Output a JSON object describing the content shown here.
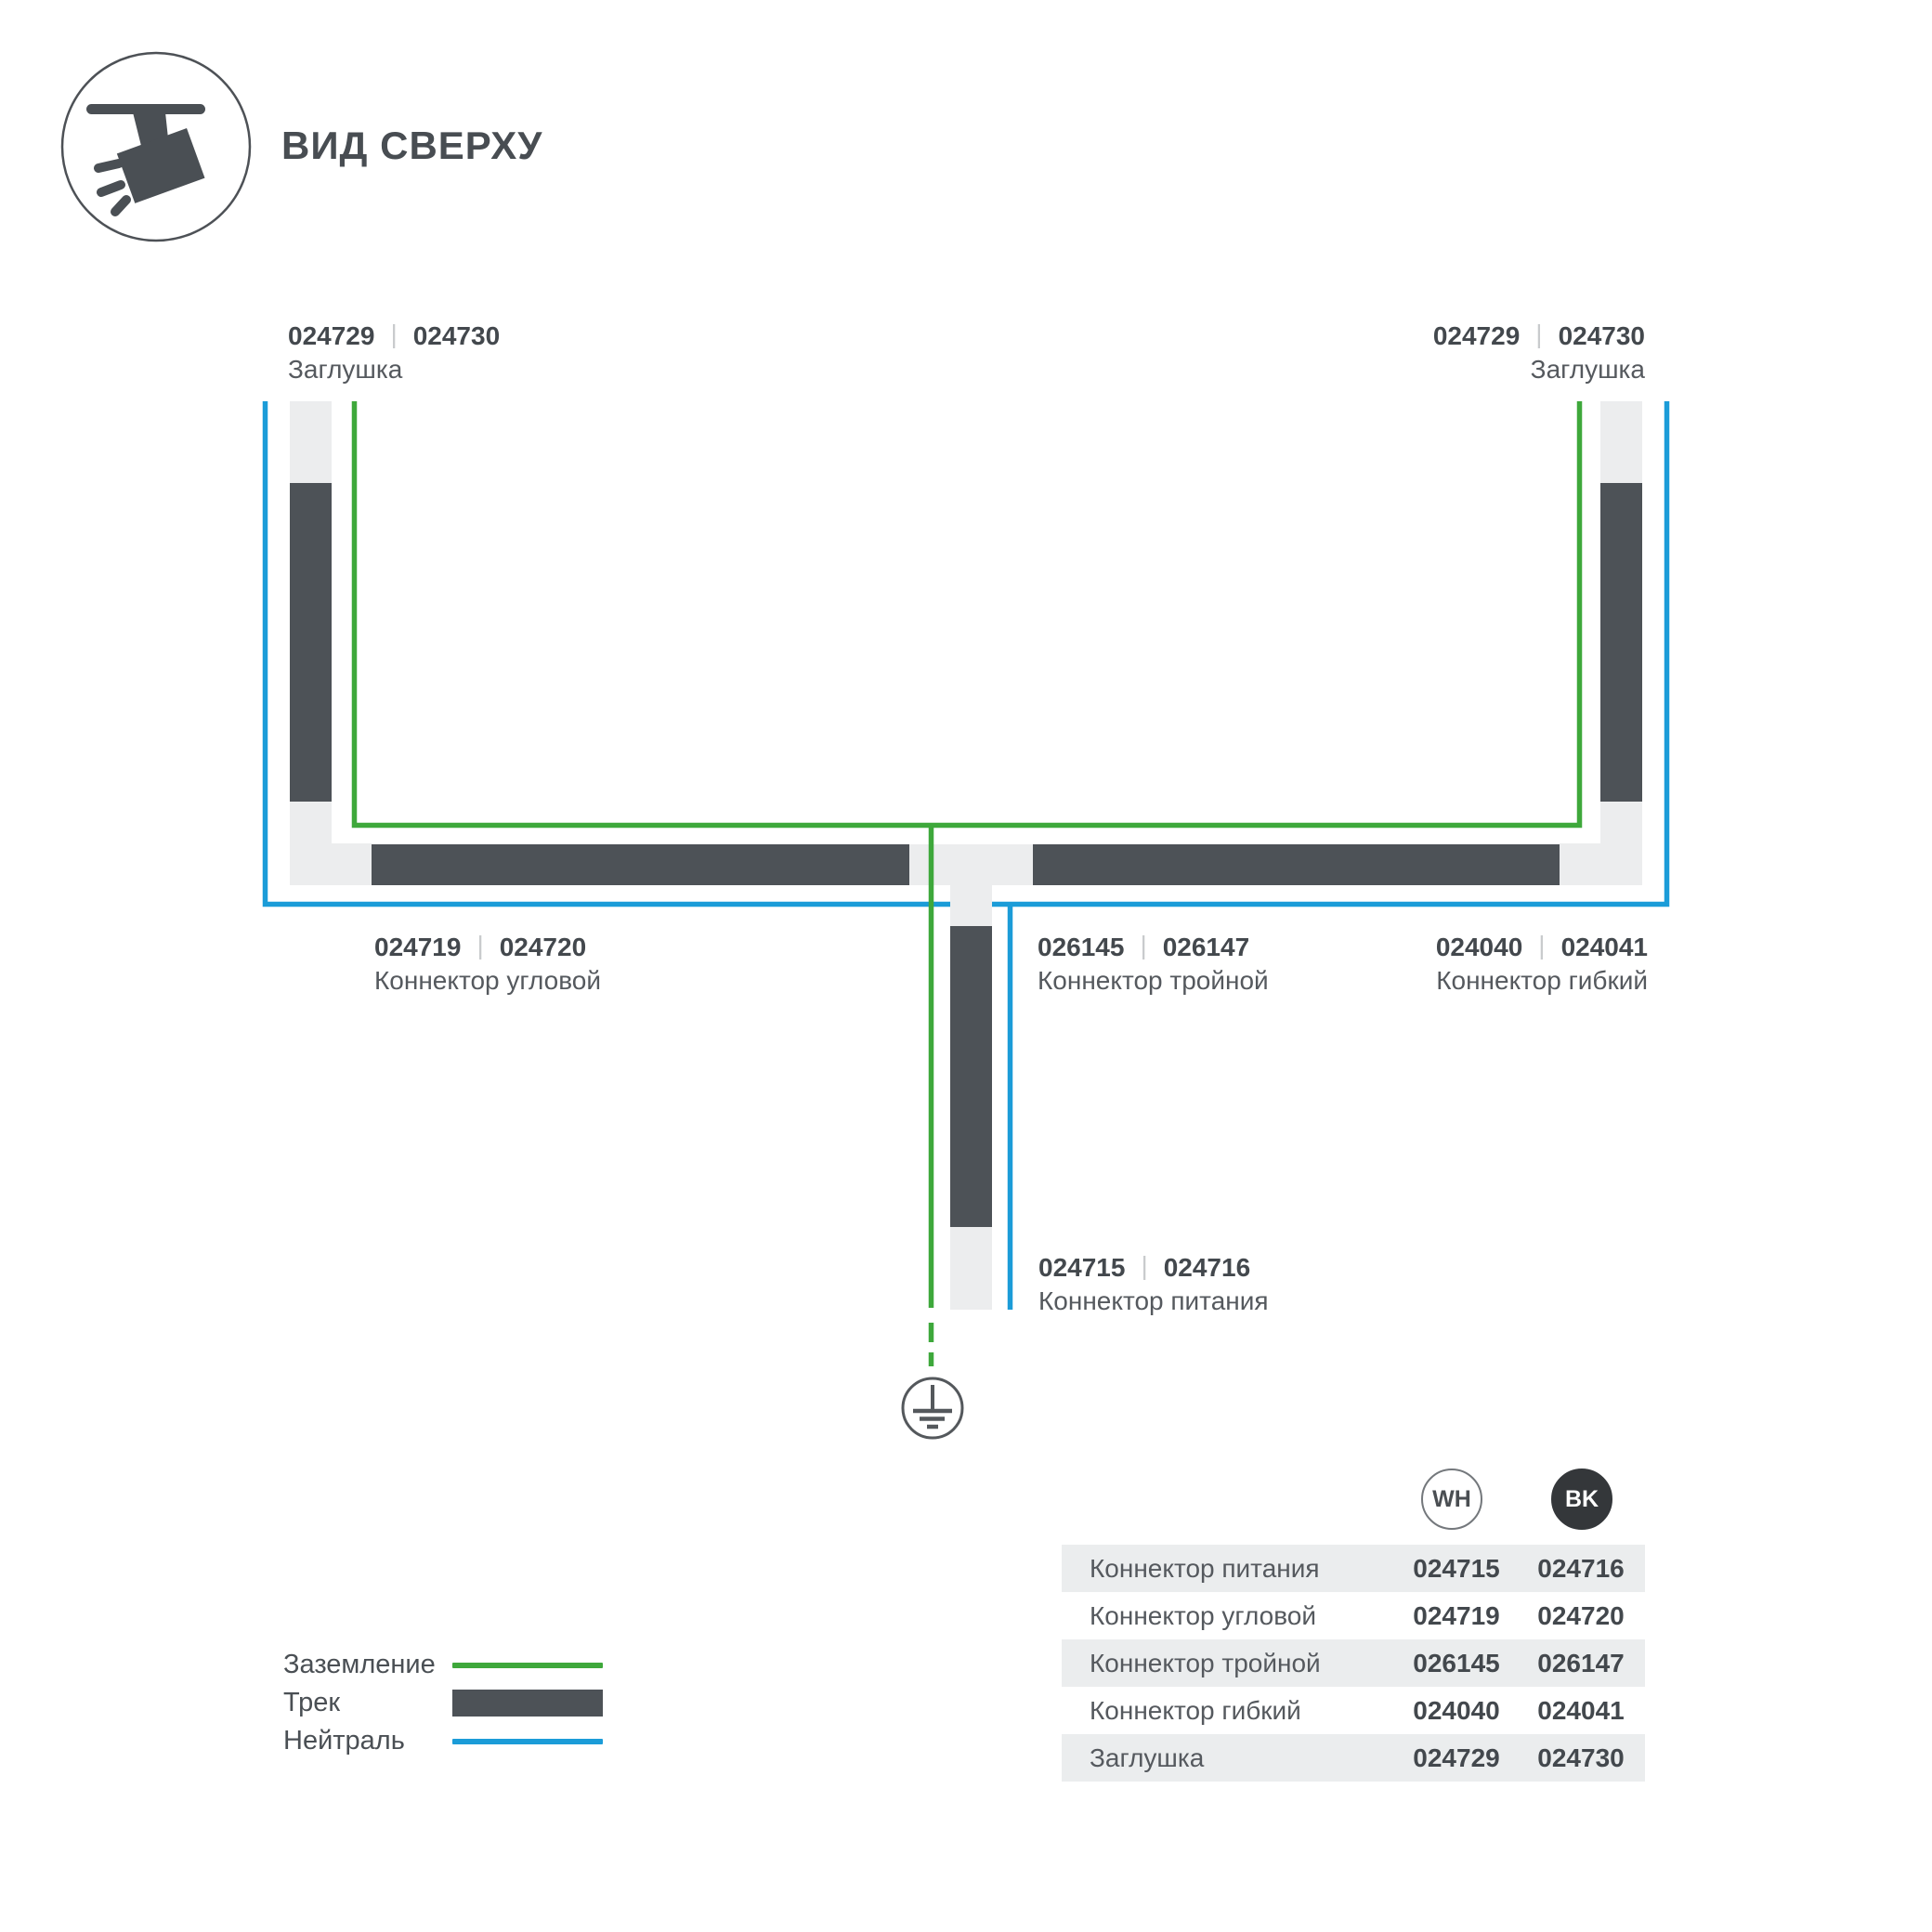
{
  "header": {
    "title": "ВИД СВЕРХУ",
    "icon": "track-light-icon"
  },
  "colors": {
    "track_dark": "#4d5257",
    "connector_light": "#ecedee",
    "ground_green": "#3ea83b",
    "neutral_blue": "#1b9cd8",
    "text_dark": "#43484d",
    "badge_bk_fill": "#34373a",
    "table_stripe": "#ebedee"
  },
  "diagram": {
    "divider": "|",
    "labels": {
      "endcap_left": {
        "wh": "024729",
        "bk": "024730",
        "name": "Заглушка"
      },
      "endcap_right": {
        "wh": "024729",
        "bk": "024730",
        "name": "Заглушка"
      },
      "corner": {
        "wh": "024719",
        "bk": "024720",
        "name": "Коннектор угловой"
      },
      "triple": {
        "wh": "026145",
        "bk": "026147",
        "name": "Коннектор тройной"
      },
      "flexible": {
        "wh": "024040",
        "bk": "024041",
        "name": "Коннектор гибкий"
      },
      "power": {
        "wh": "024715",
        "bk": "024716",
        "name": "Коннектор питания"
      }
    },
    "symbols": {
      "ground": "earth-ground-symbol"
    }
  },
  "legend": {
    "items": [
      {
        "label": "Заземление",
        "type": "line",
        "color": "#3ea83b"
      },
      {
        "label": "Трек",
        "type": "bar",
        "color": "#4d5257"
      },
      {
        "label": "Нейтраль",
        "type": "line",
        "color": "#1b9cd8"
      }
    ]
  },
  "table": {
    "columns": {
      "wh": "WH",
      "bk": "BK"
    },
    "rows": [
      {
        "name": "Коннектор питания",
        "wh": "024715",
        "bk": "024716"
      },
      {
        "name": "Коннектор угловой",
        "wh": "024719",
        "bk": "024720"
      },
      {
        "name": "Коннектор тройной",
        "wh": "026145",
        "bk": "026147"
      },
      {
        "name": "Коннектор гибкий",
        "wh": "024040",
        "bk": "024041"
      },
      {
        "name": "Заглушка",
        "wh": "024729",
        "bk": "024730"
      }
    ]
  }
}
